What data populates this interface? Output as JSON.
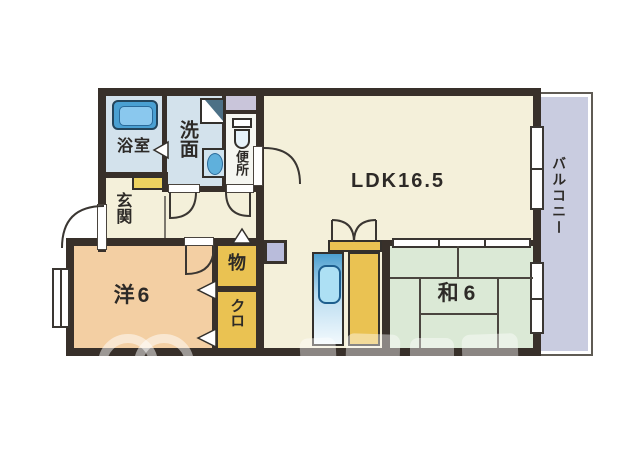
{
  "floorplan": {
    "type": "apartment-floor-plan",
    "rooms": {
      "bath": {
        "label": "浴室"
      },
      "washroom": {
        "label": "洗面"
      },
      "toilet": {
        "label": "便所"
      },
      "entrance": {
        "label": "玄関"
      },
      "ldk": {
        "label": "LDK16.5"
      },
      "japanese_room": {
        "label": "和6"
      },
      "western_room": {
        "label": "洋6"
      },
      "storage": {
        "label": "物"
      },
      "closet": {
        "label": "クロ"
      },
      "balcony": {
        "label": "バルコニー"
      }
    },
    "icons": [
      "bathtub-icon",
      "washing-machine-icon",
      "vanity-sink-icon",
      "toilet-icon",
      "kitchen-sink-icon",
      "door-arc-icon",
      "folding-door-triangle-icon",
      "window-icon",
      "sliding-door-icon"
    ],
    "colors": {
      "wall": "#38302a",
      "ldk_floor": "#f4f0da",
      "wet_area_floor": "#d3e2ec",
      "toilet_floor": "#f5f6f1",
      "western_room_floor": "#f3cfa3",
      "tatami_floor": "#dbe9d6",
      "closet_yellow": "#eac252",
      "shoe_cabinet_yellow": "#ecd260",
      "balcony_floor": "#c9cce0",
      "pipe_space": "#c9c5da",
      "fixture_blue": "#4aa0d2"
    }
  }
}
